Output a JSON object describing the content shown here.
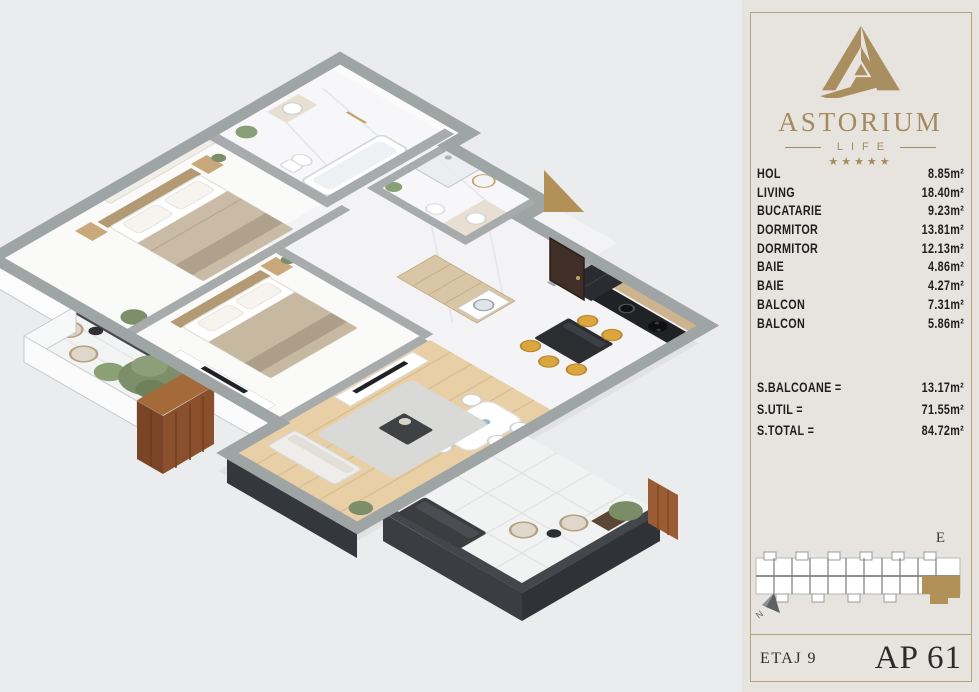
{
  "brand": {
    "name": "ASTORIUM",
    "sub": "LIFE",
    "stars": "★★★★★"
  },
  "rooms": [
    {
      "name": "HOL",
      "area": "8.85m²"
    },
    {
      "name": "LIVING",
      "area": "18.40m²"
    },
    {
      "name": "BUCATARIE",
      "area": "9.23m²"
    },
    {
      "name": "DORMITOR",
      "area": "13.81m²"
    },
    {
      "name": "DORMITOR",
      "area": "12.13m²"
    },
    {
      "name": "BAIE",
      "area": "4.86m²"
    },
    {
      "name": "BAIE",
      "area": "4.27m²"
    },
    {
      "name": "BALCON",
      "area": "7.31m²"
    },
    {
      "name": "BALCON",
      "area": "5.86m²"
    }
  ],
  "totals": [
    {
      "label": "S.BALCOANE =",
      "value": "13.17m²"
    },
    {
      "label": "S.UTIL =",
      "value": "71.55m²"
    },
    {
      "label": "S.TOTAL =",
      "value": "84.72m²"
    }
  ],
  "footer": {
    "floor": "ETAJ 9",
    "apartment": "AP 61"
  },
  "keyplan": {
    "section_label": "E",
    "compass_letter": "N"
  },
  "colors": {
    "gold": "#a58a5e",
    "wall_gray": "#9fa4a4",
    "charcoal": "#33363b",
    "wood": "#9a5c34",
    "accent_yellow": "#dba63e"
  }
}
